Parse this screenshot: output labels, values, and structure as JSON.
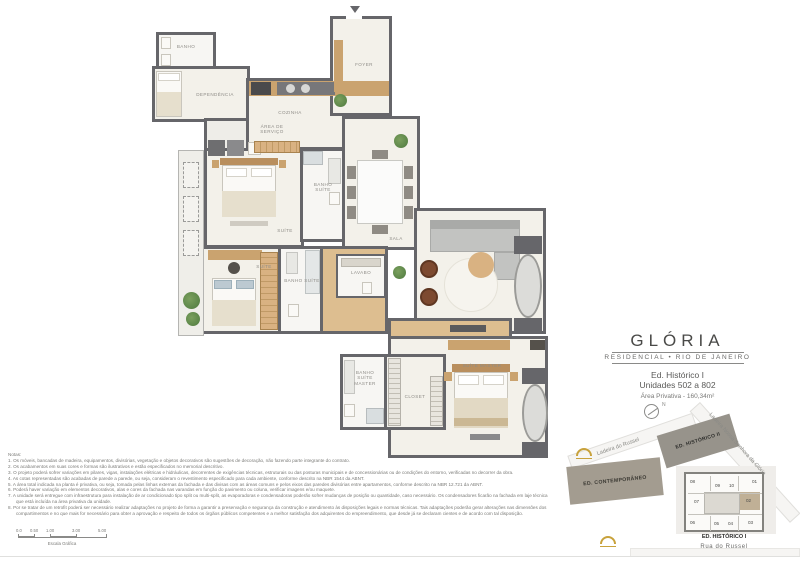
{
  "title_block": {
    "title": "GLÓRIA",
    "subtitle": "RESIDENCIAL • RIO DE JANEIRO",
    "building": "Ed. Histórico I",
    "units": "Unidades 502 a 802",
    "area": "Área Privativa - 160,34m²",
    "north_label": "N"
  },
  "plan": {
    "rooms": [
      {
        "id": "banho",
        "label": "BANHO"
      },
      {
        "id": "dependencia",
        "label": "DEPENDÊNCIA"
      },
      {
        "id": "area-servico",
        "label": "ÁREA DE SERVIÇO"
      },
      {
        "id": "cozinha",
        "label": "COZINHA"
      },
      {
        "id": "foyer",
        "label": "FOYER"
      },
      {
        "id": "suite-1",
        "label": "SUÍTE"
      },
      {
        "id": "banho-suite-1",
        "label": "BANHO SUÍTE"
      },
      {
        "id": "sala",
        "label": "SALA"
      },
      {
        "id": "suite-2",
        "label": "SUÍTE"
      },
      {
        "id": "banho-suite-2",
        "label": "BANHO SUÍTE"
      },
      {
        "id": "lavabo",
        "label": "LAVABO"
      },
      {
        "id": "banho-suite-master",
        "label": "BANHO SUÍTE MASTER"
      },
      {
        "id": "closet",
        "label": "CLOSET"
      },
      {
        "id": "suite-master",
        "label": "SUÍTE MASTER"
      }
    ]
  },
  "notes": {
    "heading": "Notas:",
    "items": [
      "1. Os móveis, bancadas de madeira, equipamentos, divisórias, vegetação e objetos decorativos são sugestões de decoração, não fazendo parte integrante do contrato.",
      "2. Os acabamentos em suas cores e formas são ilustrativos e estão especificados no memorial descritivo.",
      "3. O projeto poderá sofrer variações em pilares, vigas, instalações elétricas e hidráulicas, decorrentes de exigências técnicas, estruturais ou das posturas municipais e de concessionárias ou de condições do entorno, verificadas no decorrer da obra.",
      "4. As cotas representadas são acabadas de parede a parede, ou seja, consideram o revestimento especificado para cada ambiente, conforme descrito na NBR 1544 da ABNT.",
      "5. A área total indicada na planta é privativa, ou seja, tomada pelas linhas externas da fachada e das divisas com as áreas comuns e pelos eixos das paredes divisórias entre apartamentos, conforme descrito na NBR 12.721 da ABNT.",
      "6. Poderá haver variação em elementos decorativos, alas e cores da fachada nas varandas em função do pavimento ou coluna, verificar imagens e/ou maquete.",
      "7. A unidade será entregue com infraestrutura para instalação de ar condicionado tipo split ou multi-split, as evaporadoras e condensadoras poderão sofrer mudanças de posição ou quantidade, caso necessário. Os condensadores ficarão na fachada em laje técnica que está incluída na área privativa da unidade.",
      "8. Por se tratar de um retrofit poderá ser necessário realizar adaptações no projeto de forma a garantir a preservação e segurança da construção e atendimento às disposições legais e normas técnicas. Tais adaptações poderão gerar alterações nas dimensões dos compartimentos e no que mais for necessário para obter a aprovação e respeito de todos os órgãos públicos competentes e a melhor satisfação dos adquirentes do empreendimento, que desde já se declaram cientes e de acordo com tal disposição."
    ]
  },
  "scale_bar": {
    "ticks": [
      "0.0",
      "0.50",
      "1.00",
      "3.00",
      "5.00"
    ],
    "label": "Escala Gráfica"
  },
  "site_map": {
    "streets": [
      "Ladeira do Russel",
      "Ladeira  Nossa  Senhora  da  Glória",
      "Rua  do  Russel"
    ],
    "buildings": [
      "ED. HISTÓRICO II",
      "ED. CONTEMPORÂNEO",
      "ED. HISTÓRICO I"
    ],
    "units": [
      "08",
      "09",
      "10",
      "01",
      "07",
      "02",
      "06",
      "05",
      "04",
      "03"
    ],
    "highlighted_unit": "02"
  },
  "colors": {
    "wall": "#66666a",
    "floor": "#f3f1ea",
    "wood": "#d9b282",
    "accent_gold": "#c8a23c",
    "highlighted_unit_fill": "#c0b096"
  }
}
